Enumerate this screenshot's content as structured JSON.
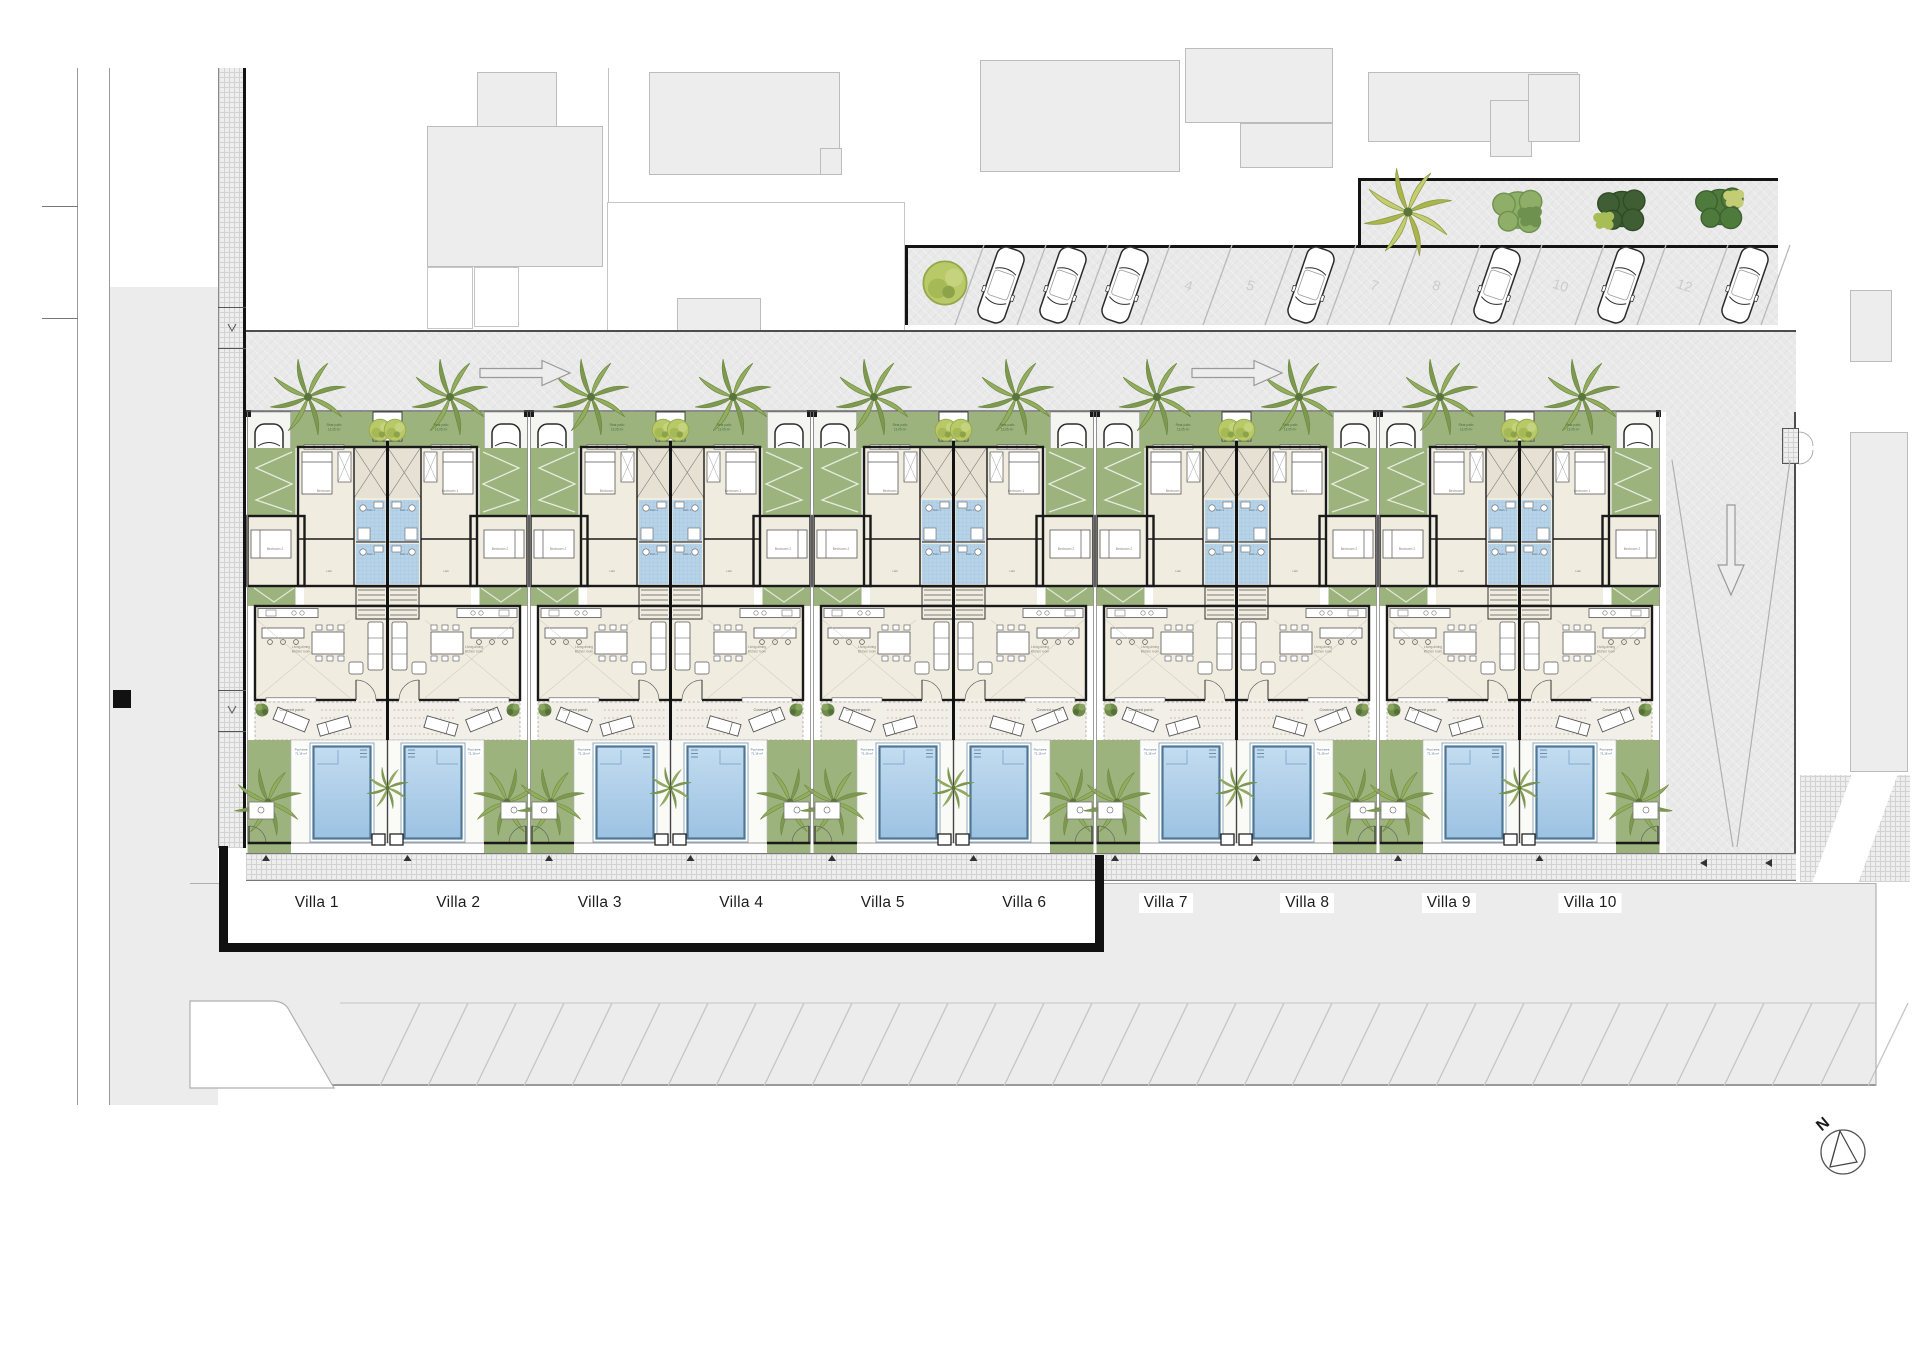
{
  "villas": [
    "Villa 1",
    "Villa 2",
    "Villa 3",
    "Villa 4",
    "Villa 5",
    "Villa 6",
    "Villa 7",
    "Villa 8",
    "Villa 9",
    "Villa 10"
  ],
  "villa_plan": {
    "rear_patio": "Rear patio",
    "rear_patio_area": "13,05 m²",
    "bedroom1": "Bedroom 1",
    "bedroom2": "Bedroom 2",
    "bath1": "Bath 1",
    "bath2": "Bath 2",
    "hall": "Hall",
    "living": "Living-dining kitchen room",
    "covered_porch": "Covered porch",
    "pool_area": "Pool area",
    "pool_area_size": "71,16 m²"
  },
  "parking": {
    "total_spaces": 13,
    "visible_space_numbers": [
      "4",
      "5",
      "7",
      "8",
      "10",
      "12"
    ],
    "occupied_space_indices": [
      1,
      2,
      3,
      6,
      9,
      11,
      13
    ]
  },
  "compass": {
    "north_label": "N"
  },
  "colors": {
    "garden_green": "#9cb37d",
    "pool_water_light": "#c3dcf0",
    "pool_water_dark": "#9cc2e2",
    "pool_rim": "#4e7796",
    "floor_beige": "#f0ecdf",
    "bath_tile": "#b7d3e8",
    "paving": "#e9e9e9",
    "wall_black": "#1a1a1a"
  }
}
